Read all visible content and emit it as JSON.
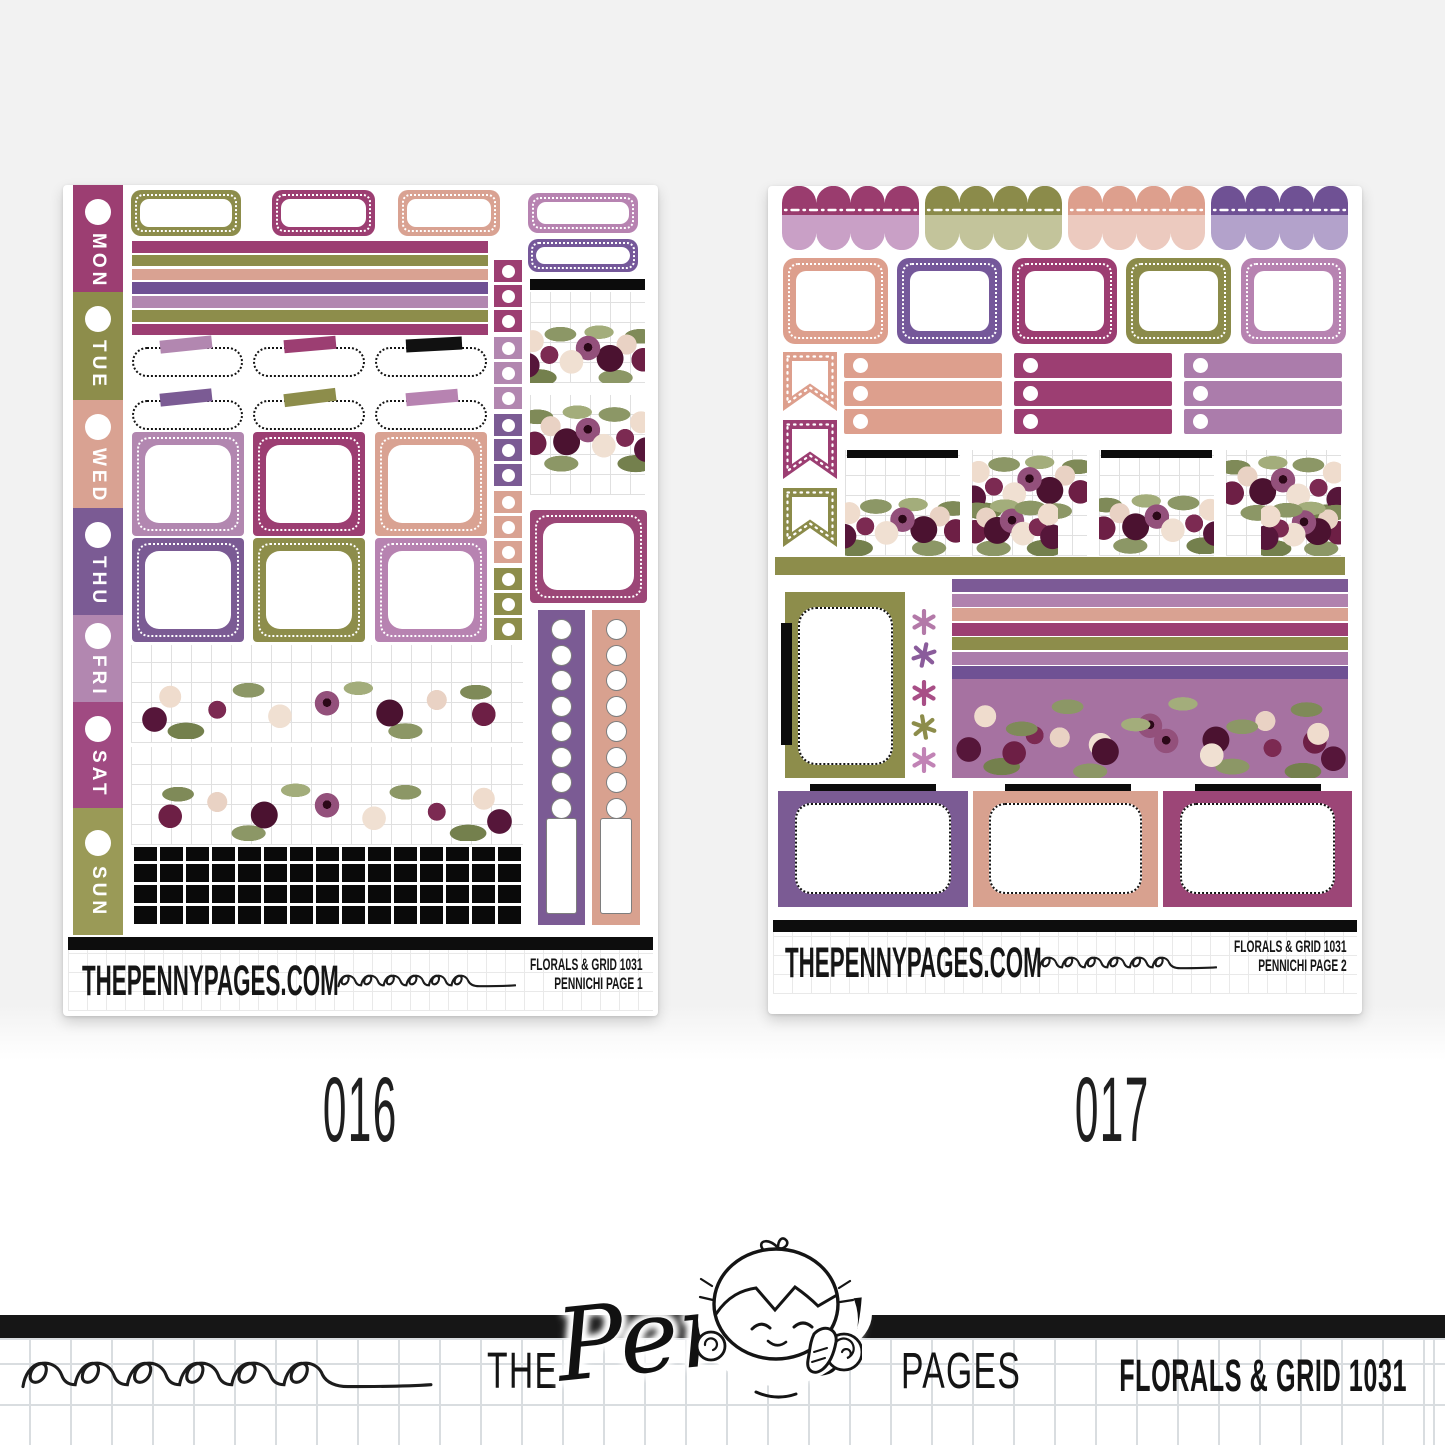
{
  "page": {
    "background_color": "#f2f2f2"
  },
  "palette": {
    "magenta": "#9c3e72",
    "orchid": "#a04a82",
    "olive": "#8d8d4b",
    "olive_light": "#c3c49b",
    "salmon": "#d9a292",
    "salmon_light": "#eccabf",
    "purple": "#7b5b94",
    "purple_deep": "#6f5194",
    "mauve": "#b287b0",
    "mauve_light": "#c9a0c6",
    "lavender": "#b3a2cb",
    "ink_black": "#111111"
  },
  "sheets": [
    {
      "id_label": "016",
      "brand": "THEPENNYPAGES.COM",
      "kit": "FLORALS & GRID 1031",
      "page_label": "PENNICHI PAGE 1",
      "days": [
        {
          "label": "MON",
          "color": "#9c3e72"
        },
        {
          "label": "TUE",
          "color": "#8d8d4b"
        },
        {
          "label": "WED",
          "color": "#d9a292"
        },
        {
          "label": "THU",
          "color": "#7b5b94"
        },
        {
          "label": "FRI",
          "color": "#b287b0"
        },
        {
          "label": "SAT",
          "color": "#a04a82"
        },
        {
          "label": "SUN",
          "color": "#9a9a57"
        }
      ]
    },
    {
      "id_label": "017",
      "brand": "THEPENNYPAGES.COM",
      "kit": "FLORALS & GRID 1031",
      "page_label": "PENNICHI PAGE 2"
    }
  ],
  "footer": {
    "brand_prefix": "THE",
    "brand_script": "Penny",
    "brand_suffix": "PAGES",
    "kit": "FLORALS & GRID 1031"
  }
}
